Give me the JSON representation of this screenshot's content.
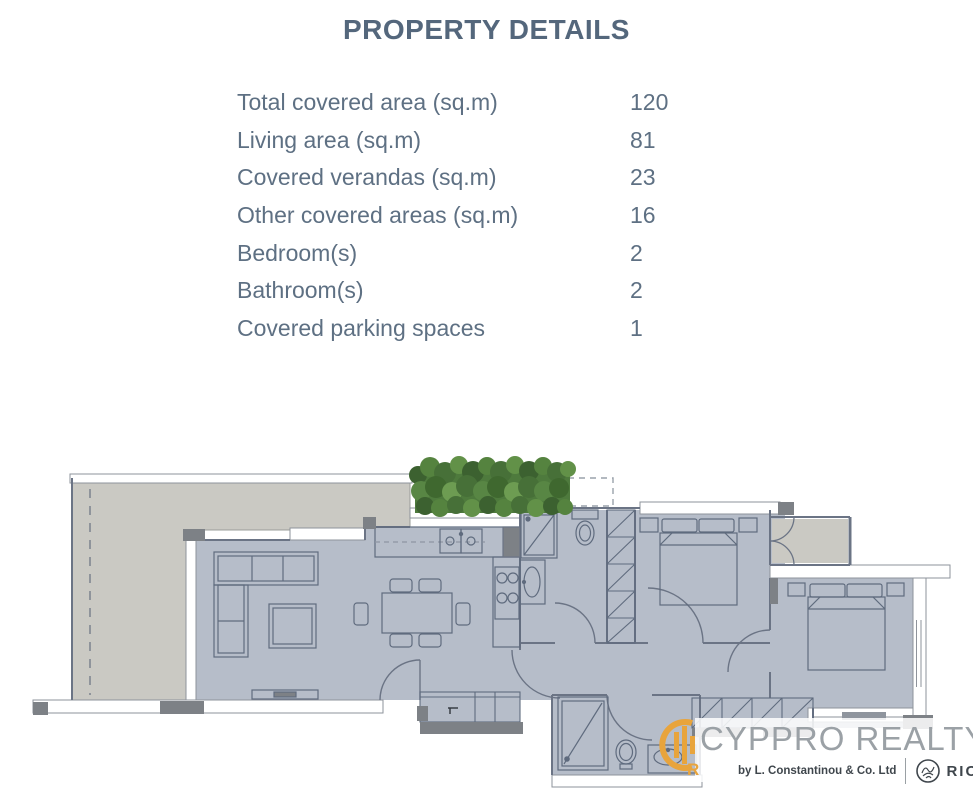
{
  "header": {
    "title": "PROPERTY DETAILS"
  },
  "property_details": {
    "rows": [
      {
        "label": "Total covered area (sq.m)",
        "value": "120"
      },
      {
        "label": "Living area (sq.m)",
        "value": "81"
      },
      {
        "label": "Covered verandas (sq.m)",
        "value": "23"
      },
      {
        "label": "Other covered areas (sq.m)",
        "value": "16"
      },
      {
        "label": "Bedroom(s)",
        "value": "2"
      },
      {
        "label": "Bathroom(s)",
        "value": "2"
      },
      {
        "label": "Covered parking spaces",
        "value": "1"
      }
    ]
  },
  "floor_plan": {
    "type": "architectural-plan",
    "colors": {
      "interior_floor": "#b6bdc9",
      "terrace_floor": "#cac9c3",
      "wall_line": "#6b7485",
      "furniture_line": "#5f6b7e",
      "pillar_dark": "#7d8186",
      "greenery": "#4e7a3d"
    },
    "icons": [
      "sofa",
      "coffee-table",
      "dining-table",
      "tv-stand",
      "kitchen-sink",
      "stove",
      "fridge",
      "double-bed",
      "wardrobe",
      "shower",
      "toilet",
      "washbasin",
      "door-arc",
      "hedge"
    ]
  },
  "logo": {
    "brand": "CYPPRO REALTY",
    "byline": "by L. Constantinou & Co. Ltd",
    "rics_label": "RICS",
    "accent_color": "#e8a43c",
    "icons": [
      "cyppro-monogram-icon",
      "rics-lion-icon"
    ]
  }
}
